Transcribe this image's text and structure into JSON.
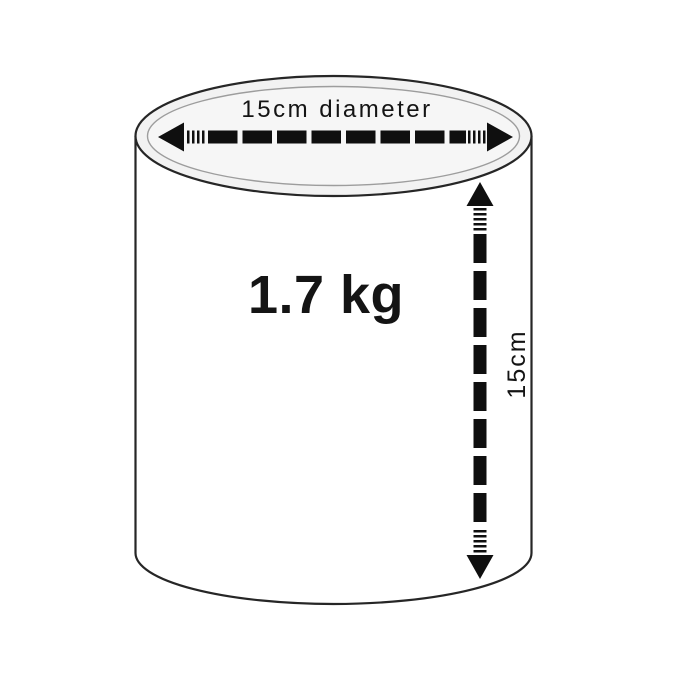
{
  "diagram": {
    "diameter_label": "15cm diameter",
    "weight_label": "1.7 kg",
    "height_label": "15cm",
    "colors": {
      "outline": "#262626",
      "rim": "#9d9d9d",
      "top_fill": "#f2f2f2",
      "top_inner_fill": "#f6f6f6",
      "body_fill": "#ffffff",
      "arrow": "#0f0f0f",
      "text": "#141414"
    }
  }
}
